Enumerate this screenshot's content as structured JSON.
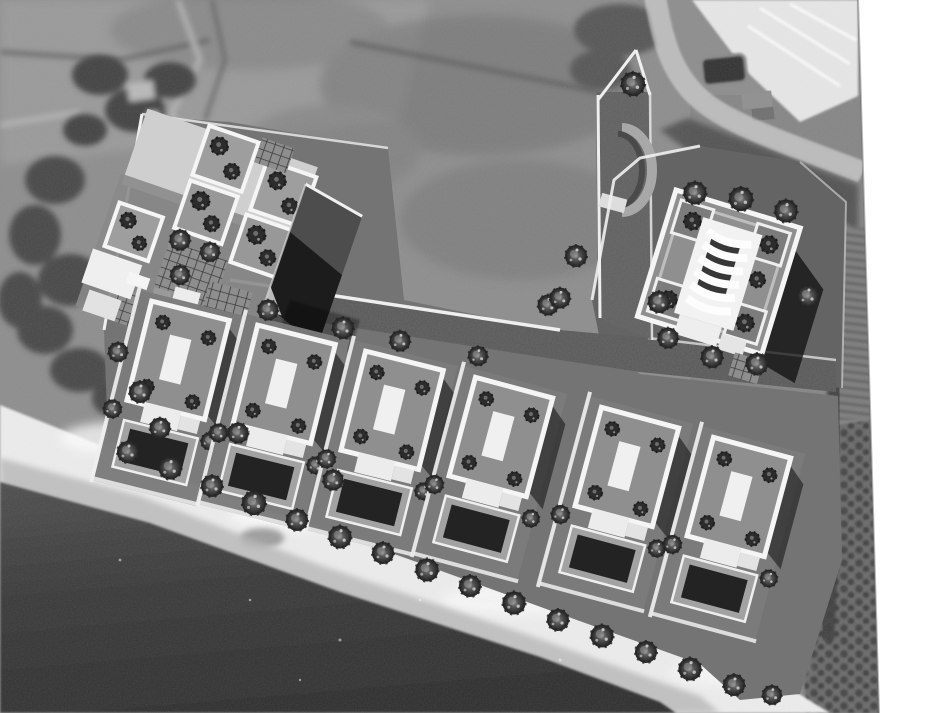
{
  "meta": {
    "description": "Black-and-white aerial photomontage: 3D architectural site-plan rendering of a beachfront residential development composited onto a grayscale aerial photograph",
    "text_content": "none (image contains no readable text)"
  },
  "palette": {
    "canvas": "#ffffff",
    "field": "#8d8d8d",
    "fieldLight": "#9b9b9b",
    "fieldDark": "#6e6e6e",
    "photoTree": "#424242",
    "hedge": "#5c5c5c",
    "track": "#b4b4b4",
    "road": "#bcbcbc",
    "roadCasing": "#e4e4e4",
    "greenhouse": "#e7e7e7",
    "veg": "#4c4c4c",
    "vineyard": "#7c7c7c",
    "vineRow": "#5e5e5e",
    "orchardBg": "#6a6a6a",
    "orchardDot": "#454545",
    "siteShadowBand": "#3c3c3c",
    "beach": "#ededed",
    "wetSand": "#b6b6b6",
    "seaTop": "#4e4e4e",
    "seaDeep": "#2f2f2f",
    "ground": "#747474",
    "plot": "#7b7b7b",
    "driveway": "#575757",
    "rightPlot": "#646464",
    "pathWhite": "#efefef",
    "parapet": "#f5f5f5",
    "roofTerrace": "#8f8f8f",
    "roofDark": "#4d4d4d",
    "skylight": "#f0f0f0",
    "terraceWhite": "#ececec",
    "poolDeck": "#a2a2a2",
    "pool": "#232323",
    "shadow": "#111111",
    "treeDark": "#2d2d2d",
    "pergBg": "#8e8e8e",
    "pergLine": "#3c3c3c",
    "edgeLine": "#6f6f6f"
  },
  "site": {
    "villas": [
      {
        "id": "villa-1",
        "transform": "translate(140 290) rotate(14)"
      },
      {
        "id": "villa-2",
        "transform": "translate(246 314) rotate(14)"
      },
      {
        "id": "villa-3",
        "transform": "translate(354 340) rotate(14)"
      },
      {
        "id": "villa-4",
        "transform": "translate(464 366) rotate(15)"
      },
      {
        "id": "villa-5",
        "transform": "translate(590 396) rotate(15)"
      },
      {
        "id": "villa-6",
        "transform": "translate(702 426) rotate(15)"
      }
    ],
    "trees": [
      [
        128,
        452,
        1
      ],
      [
        170,
        468,
        1.05
      ],
      [
        212,
        486,
        1
      ],
      [
        254,
        503,
        1.1
      ],
      [
        297,
        520,
        1
      ],
      [
        340,
        537,
        1.05
      ],
      [
        383,
        553,
        1
      ],
      [
        427,
        570,
        1.05
      ],
      [
        470,
        586,
        1
      ],
      [
        514,
        603,
        1.05
      ],
      [
        558,
        620,
        1
      ],
      [
        602,
        636,
        1.05
      ],
      [
        646,
        652,
        1
      ],
      [
        690,
        669,
        1.05
      ],
      [
        734,
        685,
        1
      ],
      [
        772,
        695,
        0.9
      ],
      [
        268,
        310,
        0.95
      ],
      [
        343,
        328,
        1
      ],
      [
        400,
        341,
        0.95
      ],
      [
        478,
        356,
        0.9
      ],
      [
        548,
        305,
        0.95
      ],
      [
        576,
        256,
        1
      ],
      [
        560,
        298,
        0.95
      ],
      [
        633,
        84,
        1.1
      ],
      [
        695,
        193,
        1.05
      ],
      [
        741,
        199,
        1.1
      ],
      [
        786,
        211,
        1.05
      ],
      [
        659,
        302,
        1
      ],
      [
        668,
        338,
        0.95
      ],
      [
        712,
        357,
        1
      ],
      [
        757,
        364,
        1
      ],
      [
        808,
        296,
        1
      ],
      [
        180,
        240,
        0.95
      ],
      [
        210,
        252,
        0.9
      ],
      [
        180,
        275,
        0.9
      ],
      [
        140,
        392,
        1
      ],
      [
        160,
        428,
        0.95
      ],
      [
        238,
        433,
        0.95
      ],
      [
        333,
        480,
        0.95
      ],
      [
        118,
        352,
        0.9
      ]
    ]
  }
}
